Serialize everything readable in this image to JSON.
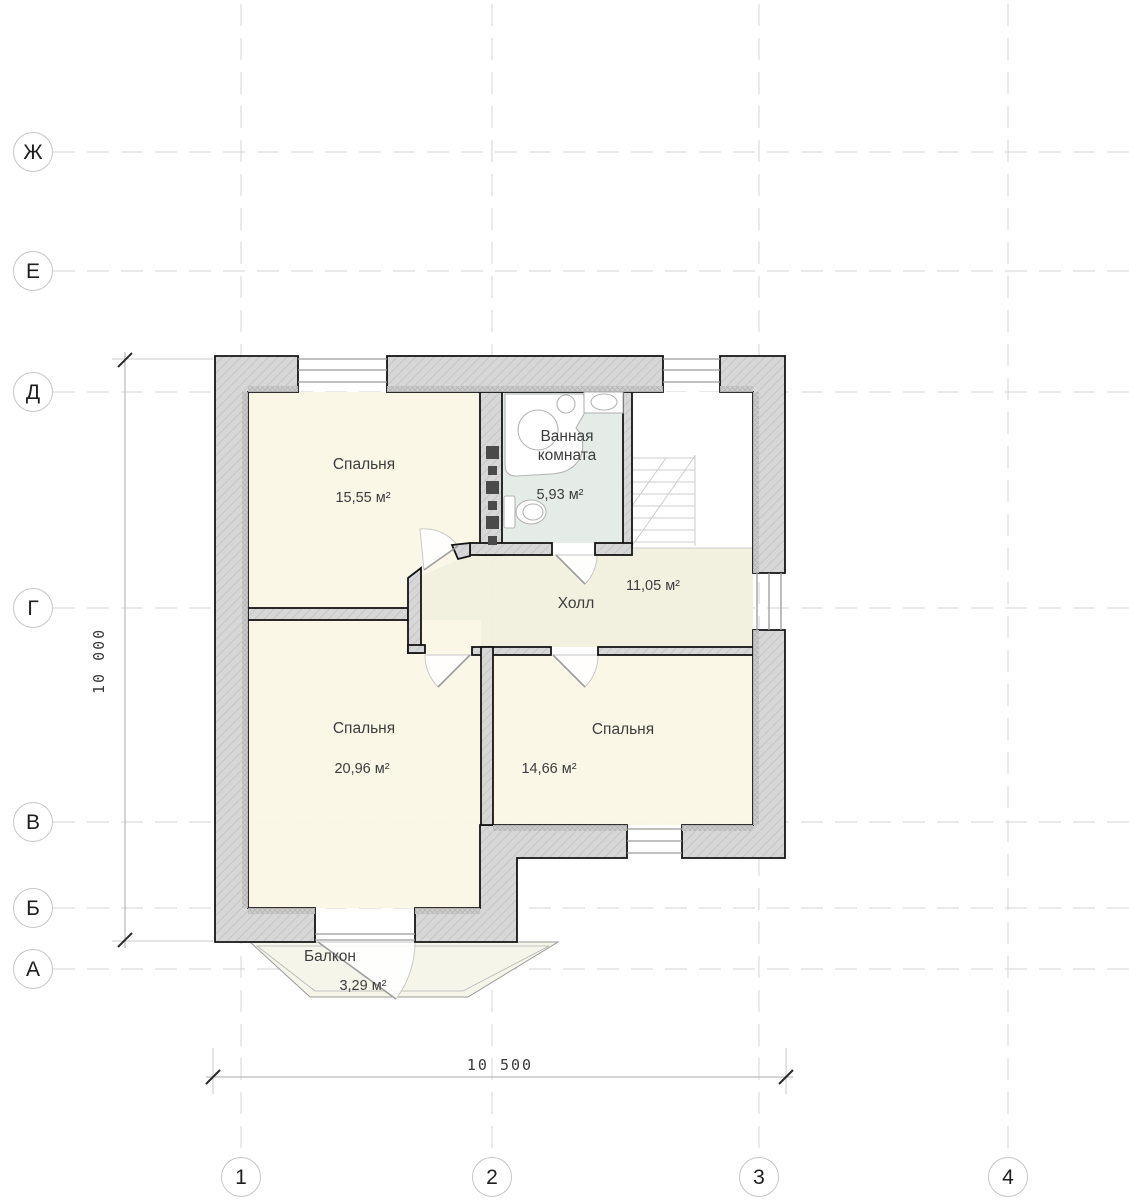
{
  "plan": {
    "title": "floor-plan-second-floor",
    "rooms": [
      {
        "id": "bedroom-top",
        "label": "Спальня",
        "area": "15,55 м²"
      },
      {
        "id": "bathroom",
        "label_line1": "Ванная",
        "label_line2": "комната",
        "area": "5,93 м²"
      },
      {
        "id": "hall",
        "label": "Холл",
        "area": "11,05 м²"
      },
      {
        "id": "bedroom-left",
        "label": "Спальня",
        "area": "20,96 м²"
      },
      {
        "id": "bedroom-right",
        "label": "Спальня",
        "area": "14,66 м²"
      },
      {
        "id": "balcony",
        "label": "Балкон",
        "area": "3,29 м²"
      }
    ]
  },
  "grid": {
    "rows": [
      "Ж",
      "Е",
      "Д",
      "Г",
      "В",
      "Б",
      "А"
    ],
    "cols": [
      "1",
      "2",
      "3",
      "4"
    ]
  },
  "dimensions": {
    "vertical": "10 000",
    "horizontal": "10 500"
  },
  "colors": {
    "wall_fill": "#d7d7d7",
    "wall_hatch": "#bfbfbf",
    "room_cream": "#fbf7e6",
    "hall_fill": "#f2f1df",
    "bathroom_fill": "#e4ebe7",
    "balcony_fill": "#f5f5e9",
    "grid_line": "#d4d4d4",
    "shaft_dark": "#4a4a4a"
  }
}
